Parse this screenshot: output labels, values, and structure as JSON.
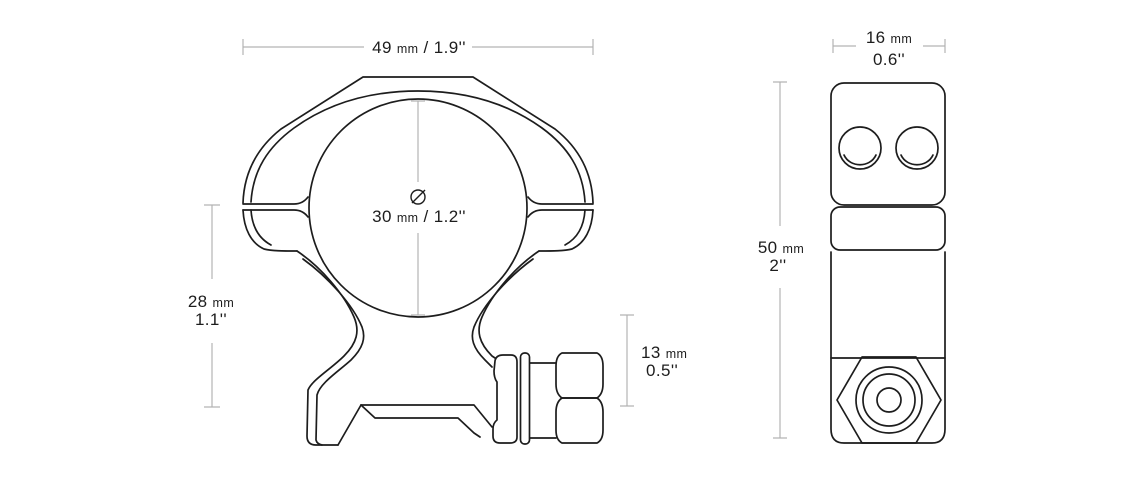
{
  "drawing": {
    "background": "#ffffff",
    "line_color": "#1d1d1d",
    "dimension_color": "#b3b3b3",
    "front_view": {
      "label": "scope-ring-front-view",
      "dimensions": {
        "overall_width": {
          "value": "49",
          "unit": "mm",
          "inches": "/ 1.9''"
        },
        "inner_diameter": {
          "value": "30",
          "unit": "mm",
          "inches": "/ 1.2''"
        },
        "saddle_height": {
          "value": "28",
          "unit": "mm",
          "inches": "1.1''"
        },
        "clamp_height": {
          "value": "13",
          "unit": "mm",
          "inches": "0.5''"
        }
      }
    },
    "side_view": {
      "label": "scope-ring-side-view",
      "dimensions": {
        "width": {
          "value": "16",
          "unit": "mm",
          "inches": "0.6''"
        },
        "height": {
          "value": "50",
          "unit": "mm",
          "inches": "2''"
        }
      }
    }
  }
}
